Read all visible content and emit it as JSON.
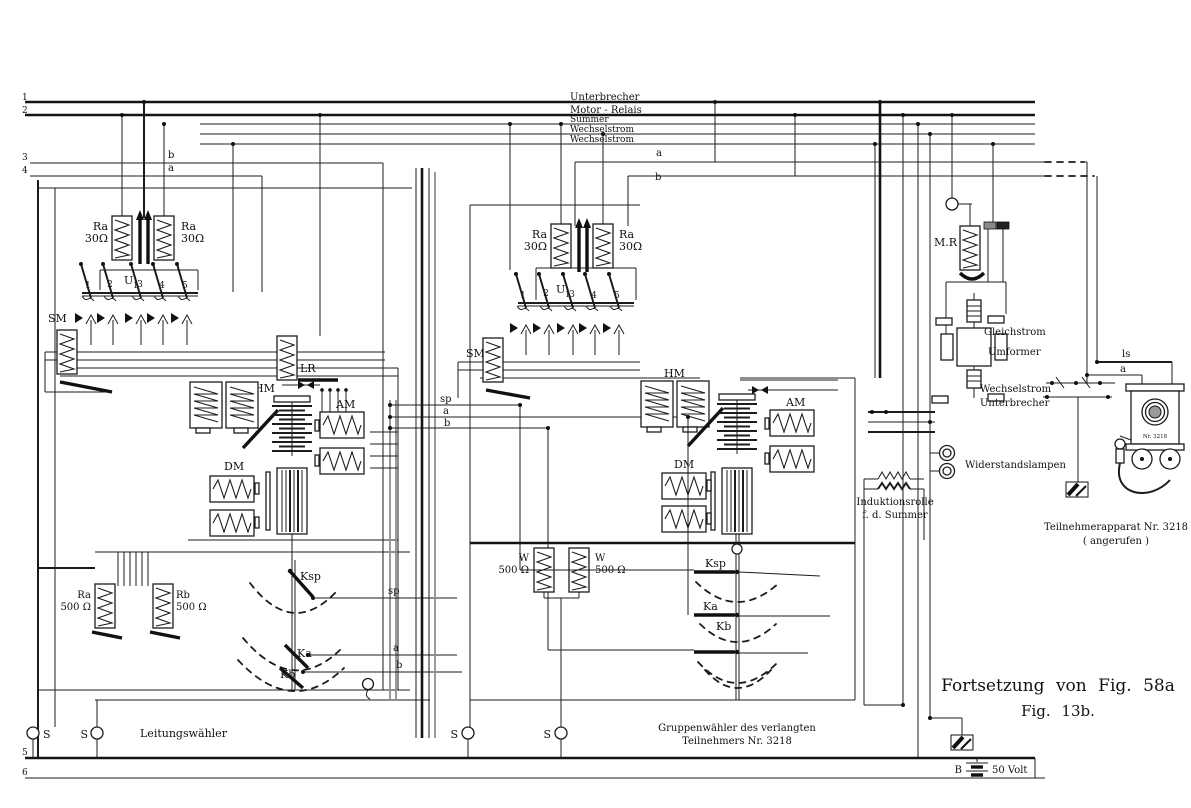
{
  "buses": [
    {
      "num": "1",
      "label": "Unterbrecher"
    },
    {
      "num": "2",
      "label": "Motor - Relais"
    },
    {
      "num": "",
      "label": "Summer"
    },
    {
      "num": "",
      "label": "Wechselstrom"
    },
    {
      "num": "",
      "label": "Wechselstrom"
    }
  ],
  "rails": {
    "n3": "3",
    "t3": "b",
    "n4": "4",
    "t4": "a",
    "n5": "5",
    "n6": "6",
    "mid_a": "a",
    "mid_b": "b"
  },
  "link": {
    "sp": "sp",
    "a": "a",
    "b": "b"
  },
  "lw": {
    "caption": "Leitungswähler",
    "s_left": "S",
    "s_right": "S",
    "ra1": {
      "name": "Ra",
      "value": "30Ω"
    },
    "ra2": {
      "name": "Ra",
      "value": "30Ω"
    },
    "u_bank": {
      "label": "U",
      "sub": "1",
      "contacts": [
        "1",
        "2",
        "3",
        "4",
        "5"
      ]
    },
    "sm": "SM",
    "lr": "LR",
    "hm": "HM",
    "am": "AM",
    "dm": "DM",
    "ra500": {
      "name": "Ra",
      "value": "500 Ω"
    },
    "rb500": {
      "name": "Rb",
      "value": "500 Ω"
    },
    "ksp": "Ksp",
    "ka": "Ka",
    "kb": "Kb",
    "tags": {
      "sp": "sp",
      "a": "a",
      "b": "b"
    }
  },
  "gw": {
    "caption1": "Gruppenwähler  des  verlangten",
    "caption2": "Teilnehmers  Nr. 3218",
    "s_left": "S",
    "s_right": "S",
    "ra1": {
      "name": "Ra",
      "value": "30Ω"
    },
    "ra2": {
      "name": "Ra",
      "value": "30Ω"
    },
    "u_bank": {
      "label": "U",
      "sub": "1",
      "contacts": [
        "1",
        "2",
        "3",
        "4",
        "5"
      ]
    },
    "sm": "SM",
    "hm": "HM",
    "am": "AM",
    "dm": "DM",
    "w1": {
      "name": "W",
      "value": "500 Ω"
    },
    "w2": {
      "name": "W",
      "value": "500 Ω"
    },
    "ksp": "Ksp",
    "ka": "Ka",
    "kb": "Kb"
  },
  "power": {
    "mr": "M.R",
    "umformer": [
      "Gleichstrom",
      "Umformer"
    ],
    "unterbrecher": [
      "Wechselstrom",
      "Unterbrecher"
    ],
    "lampen": "Widerstandslampen",
    "induktion": [
      "Induktionsrolle",
      "f. d. Summer"
    ]
  },
  "subscriber": {
    "ls": "ls",
    "a": "a",
    "plate": "Nr. 3218",
    "caption1": "Teilnehmerapparat  Nr. 3218",
    "caption2": "( angerufen )"
  },
  "battery": {
    "label": "B",
    "voltage": "50 Volt"
  },
  "figure": {
    "line1": "Fortsetzung  von  Fig.  58a",
    "line2": "Fig.  13b."
  }
}
